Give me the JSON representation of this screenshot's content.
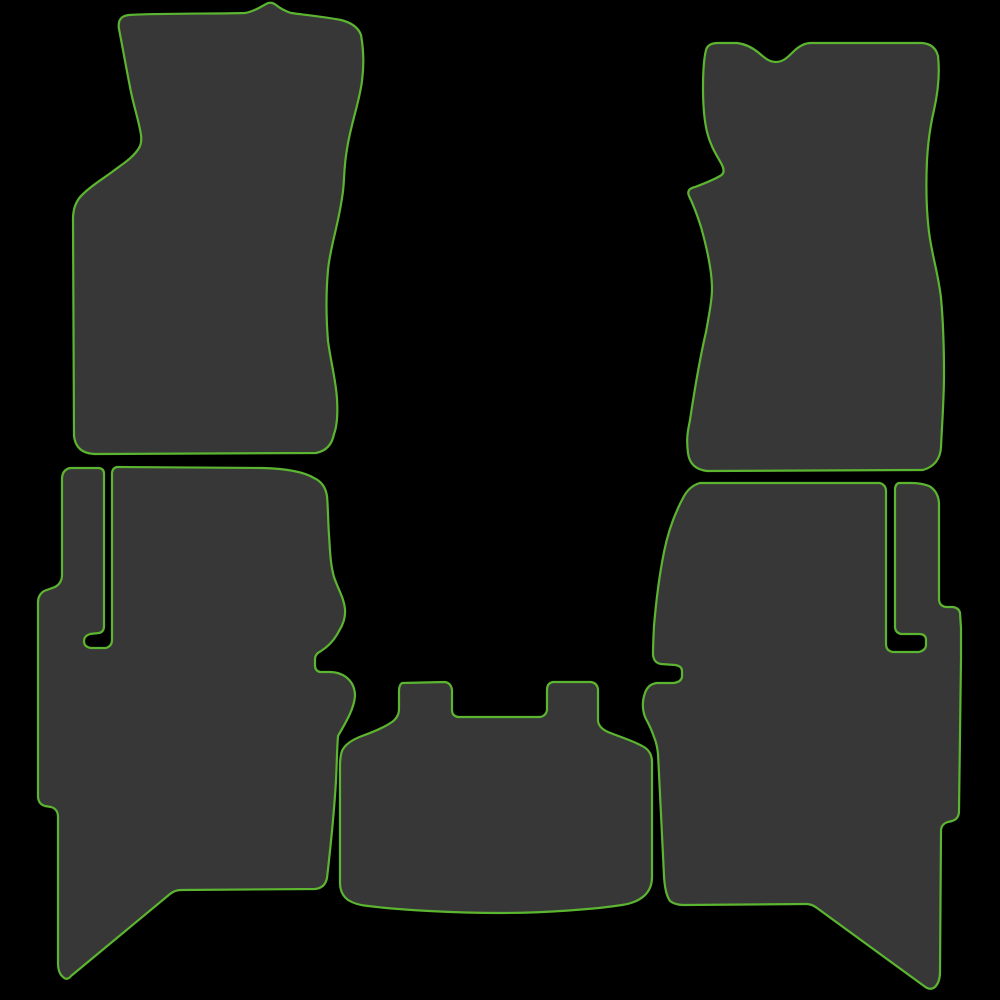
{
  "image": {
    "title": "Five-piece tailored car floor mat set",
    "description": "Silhouette product image of a 5-piece car floor mat set: front left (driver) mat, front right (passenger) mat, rear left mat, rear right mat and centre tunnel mat. Dark charcoal mats edged with bright green trim on a black background.",
    "background_color": "#000000",
    "mat_fill_color": "#373737",
    "trim_color": "#5cb530",
    "trim_width": 2.2
  },
  "mats": [
    {
      "id": "front-left-mat",
      "label": "Front left (driver side) mat",
      "path": "M 245,13 C 252,12 261,7 266,4 Q 271,1 276,5 C 281,9 285,11 291,13 C 306,15 326,17 341,20 Q 357,24 361,35 C 364,52 364,66 362,81 C 359,104 351,123 347,149 C 343,172 345,182 342,198 C 338,226 330,248 328,270 C 326,292 326,316 328,341 C 331,363 336,381 337,399 C 338,416 337,426 334,434 Q 331,450 316,453 L 94,454 Q 76,453 74,436 L 73,219 Q 73,203 83,194 C 91,186 101,180 112,172 C 121,165 133,158 139,148 Q 142,143 141,135 C 139,121 133,104 130,87 C 126,67 122,44 119,29 Q 117,16 129,15 C 162,13 212,14 245,13 Z"
    },
    {
      "id": "front-right-mat",
      "label": "Front right (passenger side) mat",
      "path": "M 737,43 C 746,44 753,48 759,53 C 765,58 769,62 776,62 C 783,62 788,57 793,52 C 798,47 804,43 811,43 L 922,43 Q 935,44 938,56 C 940,74 938,92 934,110 C 930,127 928,142 927,160 C 926,182 926,208 929,232 C 932,256 938,272 941,298 C 943,320 944,348 944,374 C 944,400 942,424 941,447 Q 940,465 923,470 L 707,471 Q 690,469 688,453 C 686,438 688,430 690,420 C 693,400 699,362 706,332 C 710,310 712,298 712,289 C 712,272 708,252 701,227 Q 695,208 689,196 Q 686,189 695,187 C 703,184 713,180 720,176 Q 726,173 722,165 C 718,157 711,148 707,132 C 704,119 703,105 703,88 C 703,72 704,58 706,50 Q 708,43 718,43 Z"
    },
    {
      "id": "rear-left-mat",
      "label": "Rear left mat",
      "path": "M 70,468 Q 62,470 62,479 L 62,575 Q 62,583 55,587 L 44,591 Q 38,595 38,602 L 38,796 Q 38,804 45,806 L 51,807 Q 58,809 58,817 L 58,963 Q 58,973 63,977 Q 67,981 71,976 L 170,894 Q 175,890 181,890 L 315,889 Q 325,888 327,878 C 330,852 334,815 336,780 C 337,760 337,748 338,736 C 346,722 354,709 355,696 Q 355,684 346,677 Q 339,672 330,672 L 320,672 Q 315,671 315,665 L 315,659 Q 315,654 321,651 C 329,646 335,639 339,631 Q 346,620 345,609 C 344,598 338,589 334,577 C 330,563 330,548 329,535 C 328,521 328,507 327,496 Q 325,483 314,478 Q 299,469 263,468 L 117,467 Q 112,468 112,474 L 112,640 Q 112,646 106,648 L 91,648 Q 84,647 84,641 Q 84,636 90,634 L 99,633 Q 104,632 104,626 L 104,474 Q 104,468 98,468 Z"
    },
    {
      "id": "centre-tunnel-mat",
      "label": "Centre tunnel mat",
      "path": "M 402,683 Q 399,685 399,691 L 399,709 Q 399,717 392,722 C 385,727 373,732 362,736 Q 346,742 342,751 Q 340,757 340,766 L 340,883 Q 340,894 348,900 Q 356,905 368,906 C 400,910 455,913 500,913 C 545,913 597,909 622,905 Q 636,903 644,896 Q 652,889 652,877 L 652,762 Q 652,752 644,747 C 634,741 620,737 608,732 Q 599,728 598,721 L 598,689 Q 597,683 591,682 L 553,682 Q 547,683 547,690 L 547,710 Q 546,716 540,717 L 458,717 Q 452,716 452,710 L 452,690 Q 451,683 445,682 Z"
    },
    {
      "id": "rear-right-mat",
      "label": "Rear right mat",
      "path": "M 700,483 Q 689,486 683,498 C 675,513 668,532 664,552 C 660,572 656,602 654,626 Q 653,645 653,655 Q 654,663 661,664 L 675,665 Q 682,666 682,671 L 682,677 Q 681,682 674,683 L 657,683 Q 648,684 645,693 C 642,701 642,711 646,719 Q 651,728 654,737 Q 657,744 658,754 C 660,790 662,838 664,876 Q 665,894 670,901 Q 675,905 684,905 L 806,904 Q 812,904 817,908 L 924,986 Q 930,991 935,987 Q 940,982 940,972 L 941,831 Q 941,824 948,822 L 952,821 Q 959,819 959,811 L 961,659 Q 961,647 961,628 L 960,613 Q 959,608 953,607 L 946,607 Q 939,606 939,599 L 939,503 Q 938,491 929,486 Q 921,483 912,483 L 899,483 Q 895,484 895,490 L 895,628 Q 896,633 901,634 L 919,634 Q 926,634 926,640 L 926,645 Q 926,650 919,652 L 893,652 Q 886,651 886,644 L 886,491 Q 886,485 880,483 Z"
    }
  ]
}
